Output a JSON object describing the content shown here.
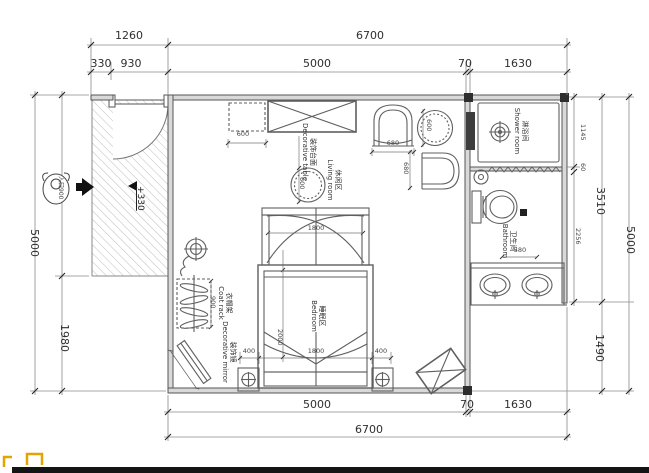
{
  "plan": {
    "dims": {
      "top_1260": "1260",
      "top_6700": "6700",
      "top_330": "330",
      "top_930": "930",
      "top_5000": "5000",
      "top_70": "70",
      "top_1630": "1630",
      "left_5000": "5000",
      "left_1980": "1980",
      "right_1145": "1145",
      "right_60": "60",
      "right_2256": "2256",
      "right_3510": "3510",
      "right_1490": "1490",
      "right_5000": "5000",
      "bottom_5000": "5000",
      "bottom_70": "70",
      "bottom_1630": "1630",
      "bottom_6700": "6700"
    },
    "small_dims": {
      "cabinet": "600",
      "table": "600",
      "side_table": "600",
      "chair_w": "680",
      "chair_h": "680",
      "canopy": "1800",
      "bed_len": "2000",
      "bed_w": "1800",
      "nightstand_l": "400",
      "nightstand_r": "400",
      "coat_rack": "900",
      "bathroom": "580"
    },
    "labels": {
      "level": "+330",
      "entry": "入口900",
      "shower_cn": "淋浴间",
      "shower_en": "Shower room",
      "bathroom_cn": "卫生间",
      "bathroom_en": "Bathroom",
      "living_cn": "休闲区",
      "living_en": "Living room",
      "bedroom_cn": "睡眠区",
      "bedroom_en": "Bedroom",
      "coat_rack_cn": "衣帽架",
      "coat_rack_en": "Coat rack",
      "mirror_cn": "装饰镜",
      "mirror_en": "Decorative mirror",
      "table_cn": "装饰台面",
      "table_en": "Decorative table"
    },
    "colors": {
      "line": "#555555",
      "wall_fill": "#d9d9d9",
      "accent_mark": "#e2a400",
      "bottom_bar": "#141414"
    }
  }
}
